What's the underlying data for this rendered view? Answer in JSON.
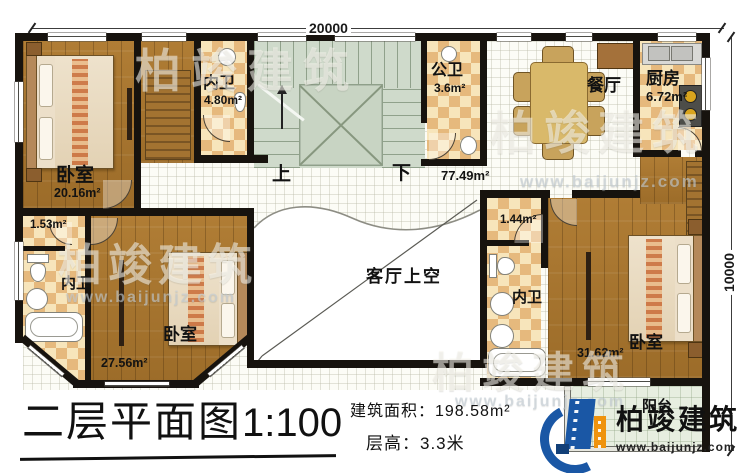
{
  "plan": {
    "dim_top": "20000",
    "dim_right": "10000",
    "stairs": {
      "up": "上",
      "down": "下"
    },
    "hall": {
      "area": "77.49m²"
    },
    "rooms": {
      "bedroom_tl": {
        "label": "卧室",
        "area": "20.16m²"
      },
      "bath_tl": {
        "label": "内卫",
        "area": "4.80m²"
      },
      "public_bath": {
        "label": "公卫",
        "area": "3.6m²"
      },
      "dining": {
        "label": "餐厅"
      },
      "kitchen": {
        "label": "厨房",
        "area": "6.72m²"
      },
      "closet_bl": {
        "area": "1.53m²"
      },
      "bath_bl": {
        "label": "内卫"
      },
      "bedroom_bl": {
        "label": "卧室",
        "area": "27.56m²"
      },
      "void": {
        "label": "客厅上空"
      },
      "closet_br": {
        "area": "1.44m²"
      },
      "bath_br": {
        "label": "内卫"
      },
      "bedroom_br": {
        "label": "卧室",
        "area": "31.62m²"
      },
      "balcony": {
        "label": "阳台"
      }
    }
  },
  "footer": {
    "title": "二层平面图",
    "scale": "1:100",
    "building_area": "建筑面积：198.58m²",
    "floor_height": "层高：3.3米"
  },
  "brand": {
    "name": "柏竣建筑",
    "url": "www.baijunjz.com"
  },
  "watermark": {
    "name": "柏竣建筑",
    "url": "www.baijunjz.com"
  },
  "colors": {
    "wall": "#17130e",
    "wood": "#a8762f",
    "tile_light": "#f7e5bb",
    "tile_dark": "#e6b97d",
    "stair": "#cfdacb",
    "brand_blue": "#1a57a5",
    "brand_orange": "#ef930e"
  }
}
